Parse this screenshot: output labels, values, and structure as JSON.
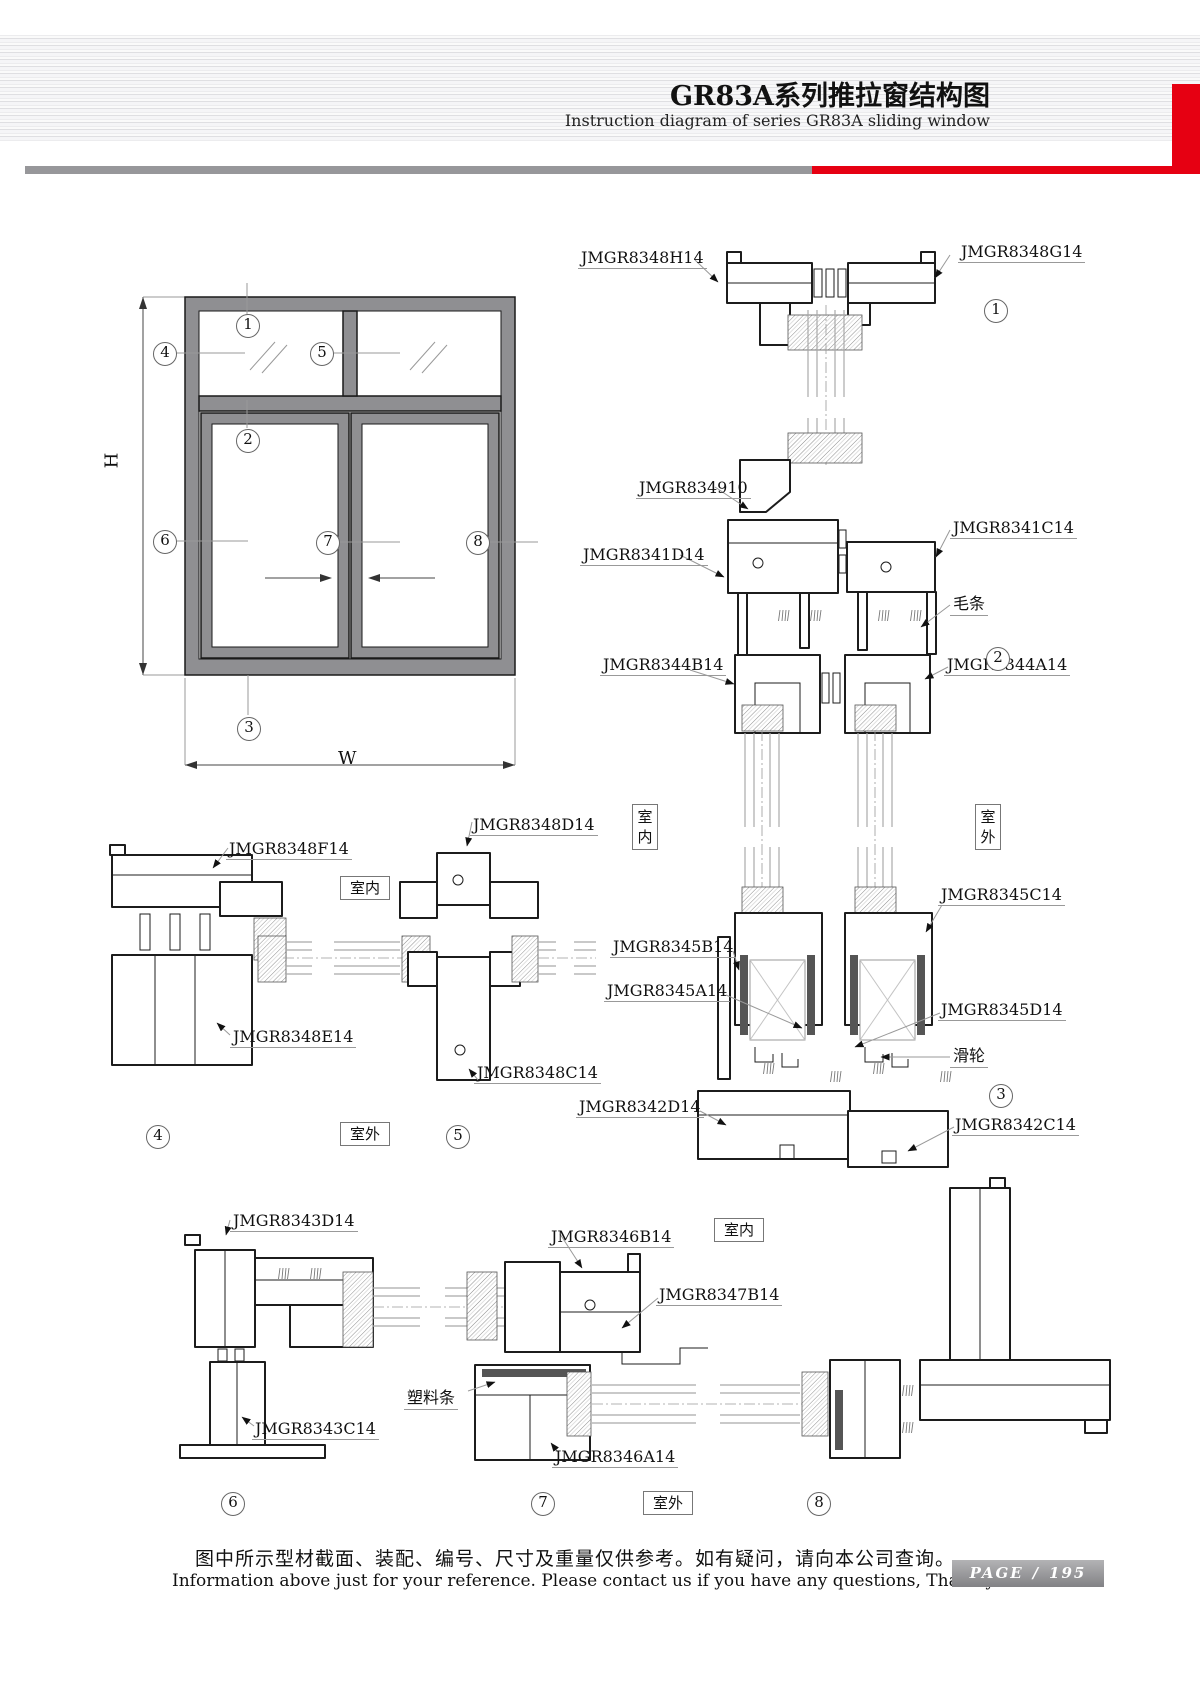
{
  "header": {
    "title": "GR83A系列推拉窗结构图",
    "subtitle": "Instruction diagram of series GR83A sliding window"
  },
  "elevation": {
    "height_label": "H",
    "width_label": "W",
    "callout_1": "1",
    "callout_2": "2",
    "callout_3": "3",
    "callout_4": "4",
    "callout_5": "5",
    "callout_6": "6",
    "callout_7": "7",
    "callout_8": "8"
  },
  "vertical_sections": {
    "jmgr8348h14": "JMGR8348H14",
    "jmgr8348g14": "JMGR8348G14",
    "jmgr834910": "JMGR834910",
    "jmgr8341d14": "JMGR8341D14",
    "jmgr8341c14": "JMGR8341C14",
    "maotiao": "毛条",
    "jmgr8344b14": "JMGR8344B14",
    "jmgr8344a14": "JMGR8344A14",
    "indoor": "室内",
    "outdoor": "室外",
    "jmgr8345c14": "JMGR8345C14",
    "jmgr8345b14": "JMGR8345B14",
    "jmgr8345a14": "JMGR8345A14",
    "jmgr8345d14": "JMGR8345D14",
    "hualun": "滑轮",
    "jmgr8342d14": "JMGR8342D14",
    "jmgr8342c14": "JMGR8342C14",
    "callout_1": "1",
    "callout_2": "2",
    "callout_3": "3"
  },
  "side_sections": {
    "jmgr8348f14": "JMGR8348F14",
    "jmgr8348d14": "JMGR8348D14",
    "jmgr8348e14": "JMGR8348E14",
    "jmgr8348c14": "JMGR8348C14",
    "indoor": "室内",
    "outdoor": "室外",
    "callout_4": "4",
    "callout_5": "5"
  },
  "bottom_sections": {
    "jmgr8343d14": "JMGR8343D14",
    "jmgr8343c14": "JMGR8343C14",
    "jmgr8346b14": "JMGR8346B14",
    "jmgr8347b14": "JMGR8347B14",
    "suliaotiao": "塑料条",
    "jmgr8346a14": "JMGR8346A14",
    "indoor": "室内",
    "outdoor": "室外",
    "callout_6": "6",
    "callout_7": "7",
    "callout_8": "8"
  },
  "footer": {
    "note_cn": "图中所示型材截面、装配、编号、尺寸及重量仅供参考。如有疑问，请向本公司查询。",
    "note_en": "Information above just for your reference. Please contact us if you have any questions, Thank you!",
    "page_label": "PAGE",
    "page_separator": "/",
    "page_number": "195"
  }
}
